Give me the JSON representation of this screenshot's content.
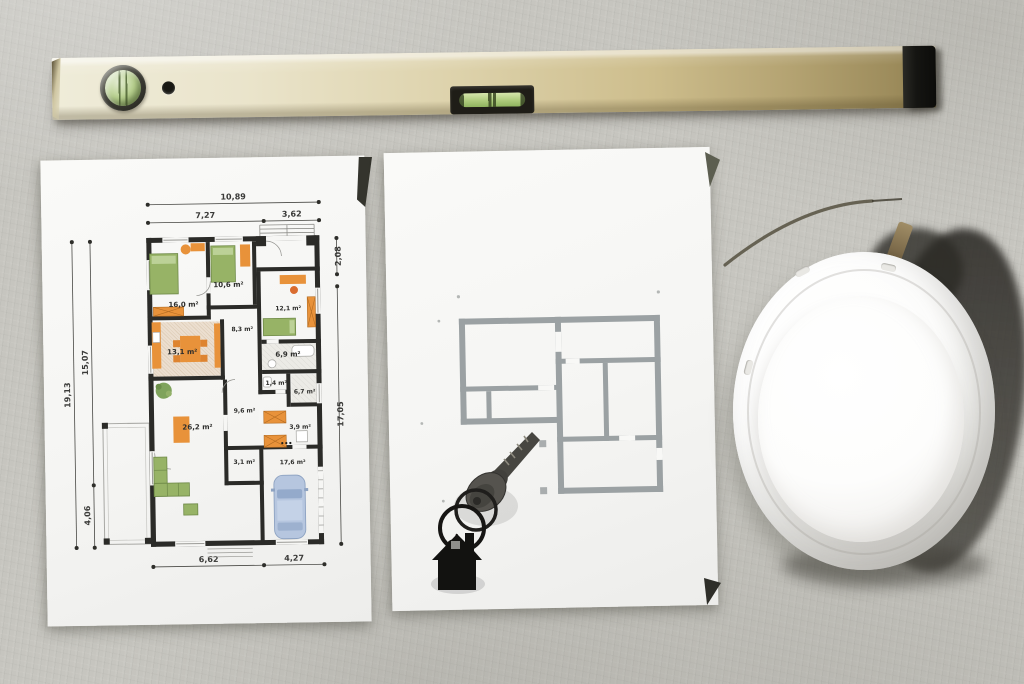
{
  "scene": {
    "surface": "concrete",
    "objects": [
      "spirit-level",
      "detailed-floor-plan-sheet",
      "outline-floor-plan-sheet",
      "keys-with-house-keychain",
      "white-hard-hat"
    ]
  },
  "palette": {
    "concrete": "#c6c5bf",
    "paper": "#f6f6f4",
    "level_brass_light": "#efecd9",
    "level_brass_dark": "#8f7f4e",
    "vial_green": "#aecb7c",
    "plan_wall_black": "#2b2b28",
    "plan_outline_gray": "#9ba1a3",
    "furniture_orange": "#e8923a",
    "furniture_green": "#97b366",
    "car_blue": "#b6c6df",
    "hat_white": "#fbfbfa",
    "cast_shadow": "#2e2c29"
  },
  "plan": {
    "dims": {
      "top_total": "10,89",
      "top_left": "7,27",
      "top_right": "3,62",
      "right_upper": "2,08",
      "right_main": "17,05",
      "left_total": "19,13",
      "left_upper": "15,07",
      "left_lower": "4,06",
      "bottom_left": "6,62",
      "bottom_right": "4,27"
    },
    "rooms": [
      {
        "label": "16,0 m²"
      },
      {
        "label": "10,6 m²"
      },
      {
        "label": "12,1 m²"
      },
      {
        "label": "8,3 m²"
      },
      {
        "label": "13,1 m²"
      },
      {
        "label": "6,9 m²"
      },
      {
        "label": "1,4 m²"
      },
      {
        "label": "6,7 m²"
      },
      {
        "label": "9,6 m²"
      },
      {
        "label": "3,9 m²"
      },
      {
        "label": "26,2 m²"
      },
      {
        "label": "3,1 m²"
      },
      {
        "label": "17,6 m²"
      }
    ]
  }
}
